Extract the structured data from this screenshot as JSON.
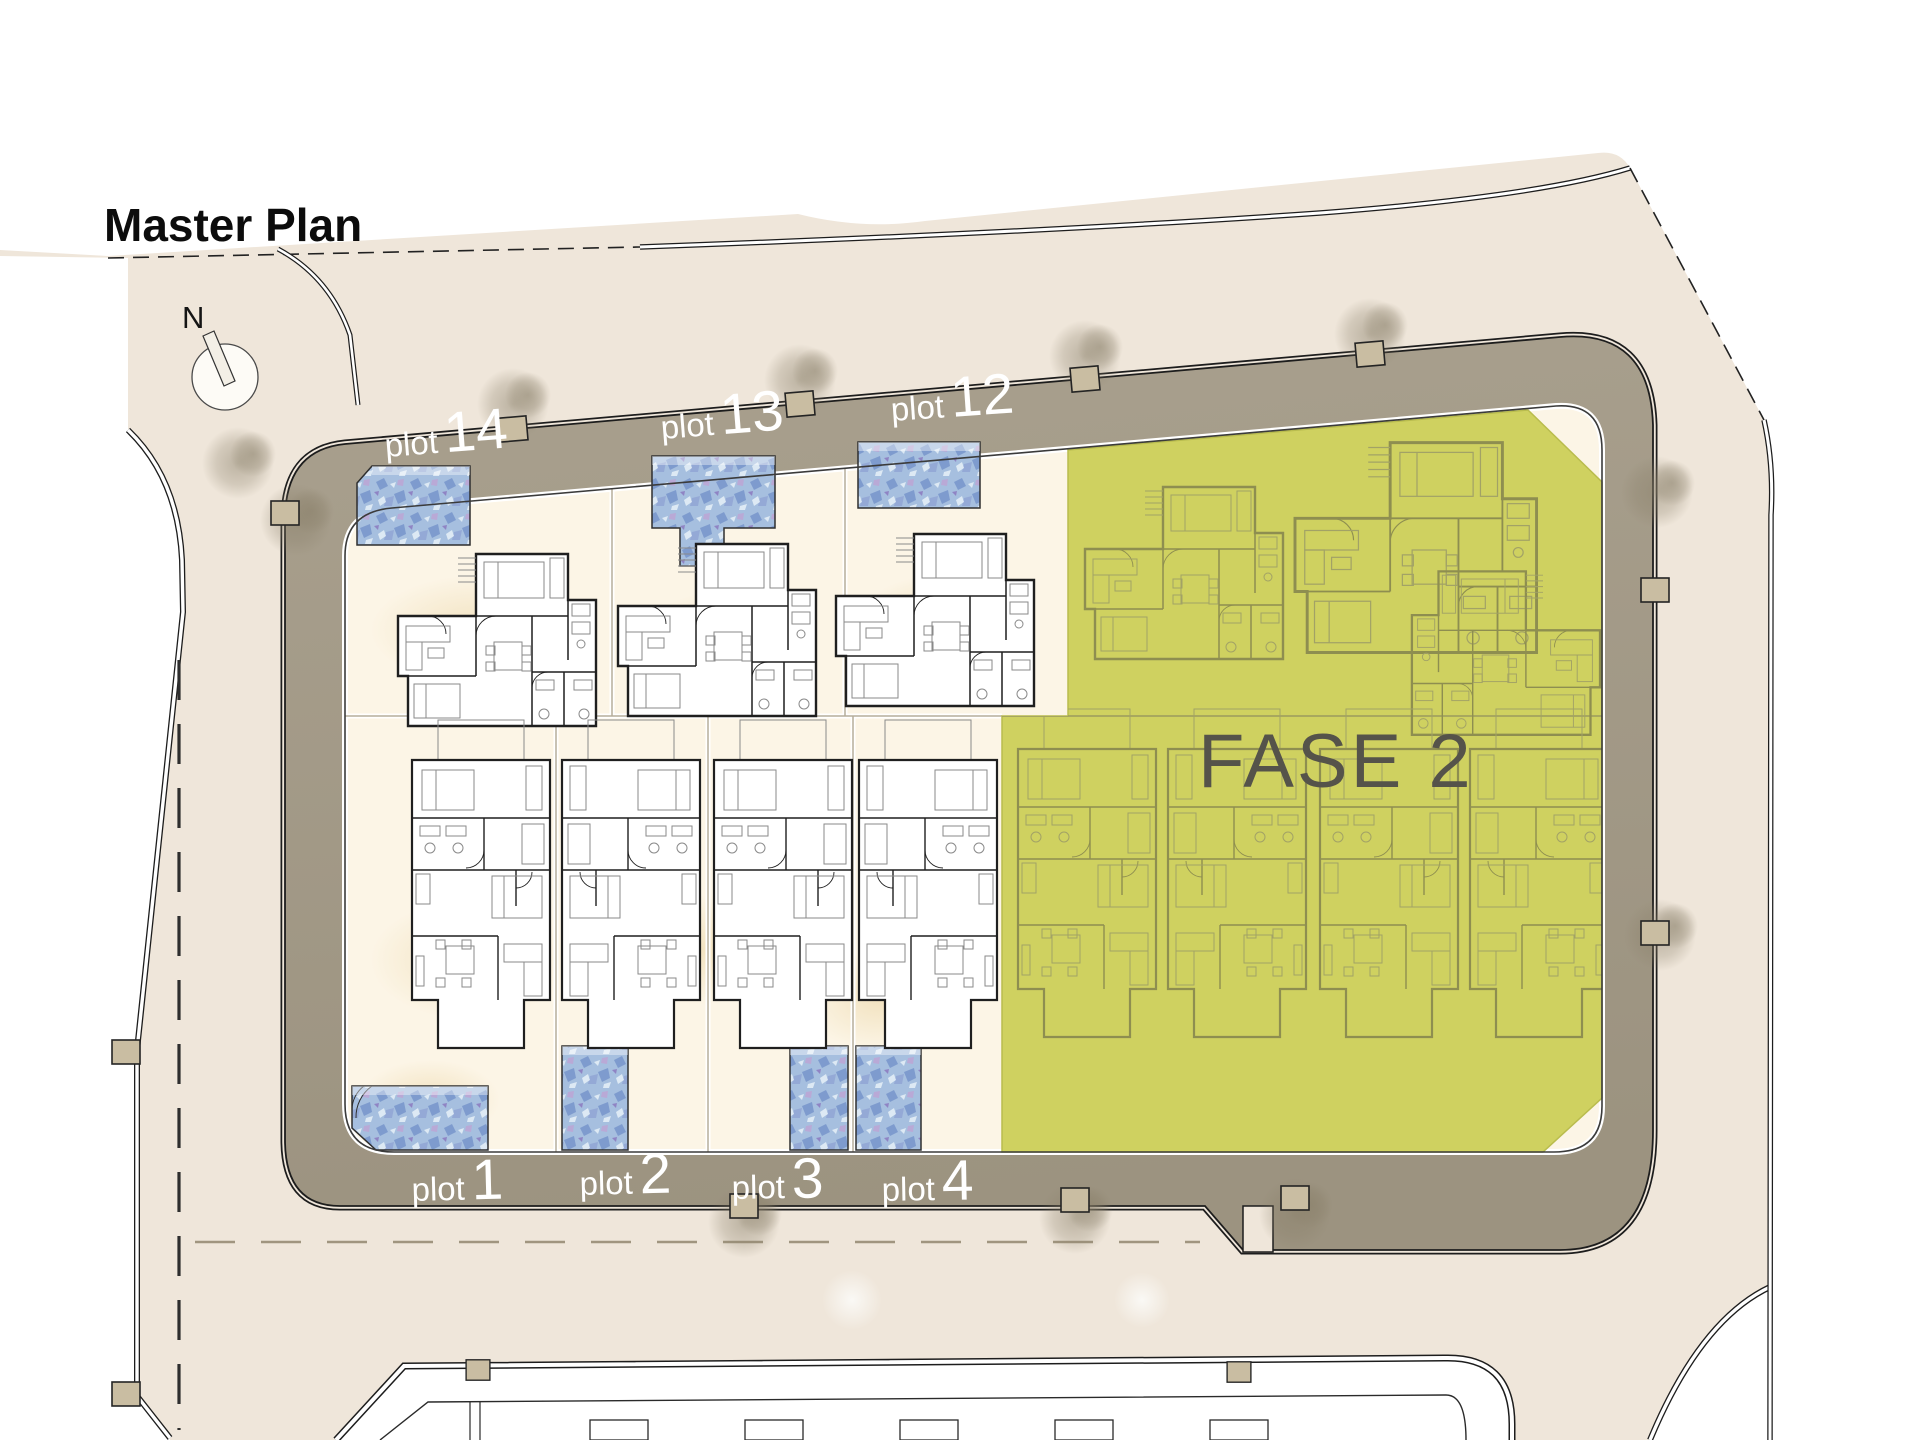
{
  "title": "Master Plan",
  "compass": {
    "label": "N"
  },
  "phase": {
    "label": "FASE 2"
  },
  "plots": {
    "top_row": [
      {
        "prefix": "plot",
        "number": "14"
      },
      {
        "prefix": "plot",
        "number": "13"
      },
      {
        "prefix": "plot",
        "number": "12"
      }
    ],
    "bottom_row": [
      {
        "prefix": "plot",
        "number": "1"
      },
      {
        "prefix": "plot",
        "number": "2"
      },
      {
        "prefix": "plot",
        "number": "3"
      },
      {
        "prefix": "plot",
        "number": "4"
      }
    ]
  },
  "colors": {
    "background_beige": "#efe6da",
    "outside_white": "#ffffff",
    "road_band": "#a49c8a",
    "phase2_fill": "#cfd160",
    "phase2_text": "#55534a",
    "pool_blue": "#a6bfdf",
    "plot_label_text": "#ffffff",
    "plan_line": "#202020",
    "field_cream": "#fcf5e6"
  }
}
